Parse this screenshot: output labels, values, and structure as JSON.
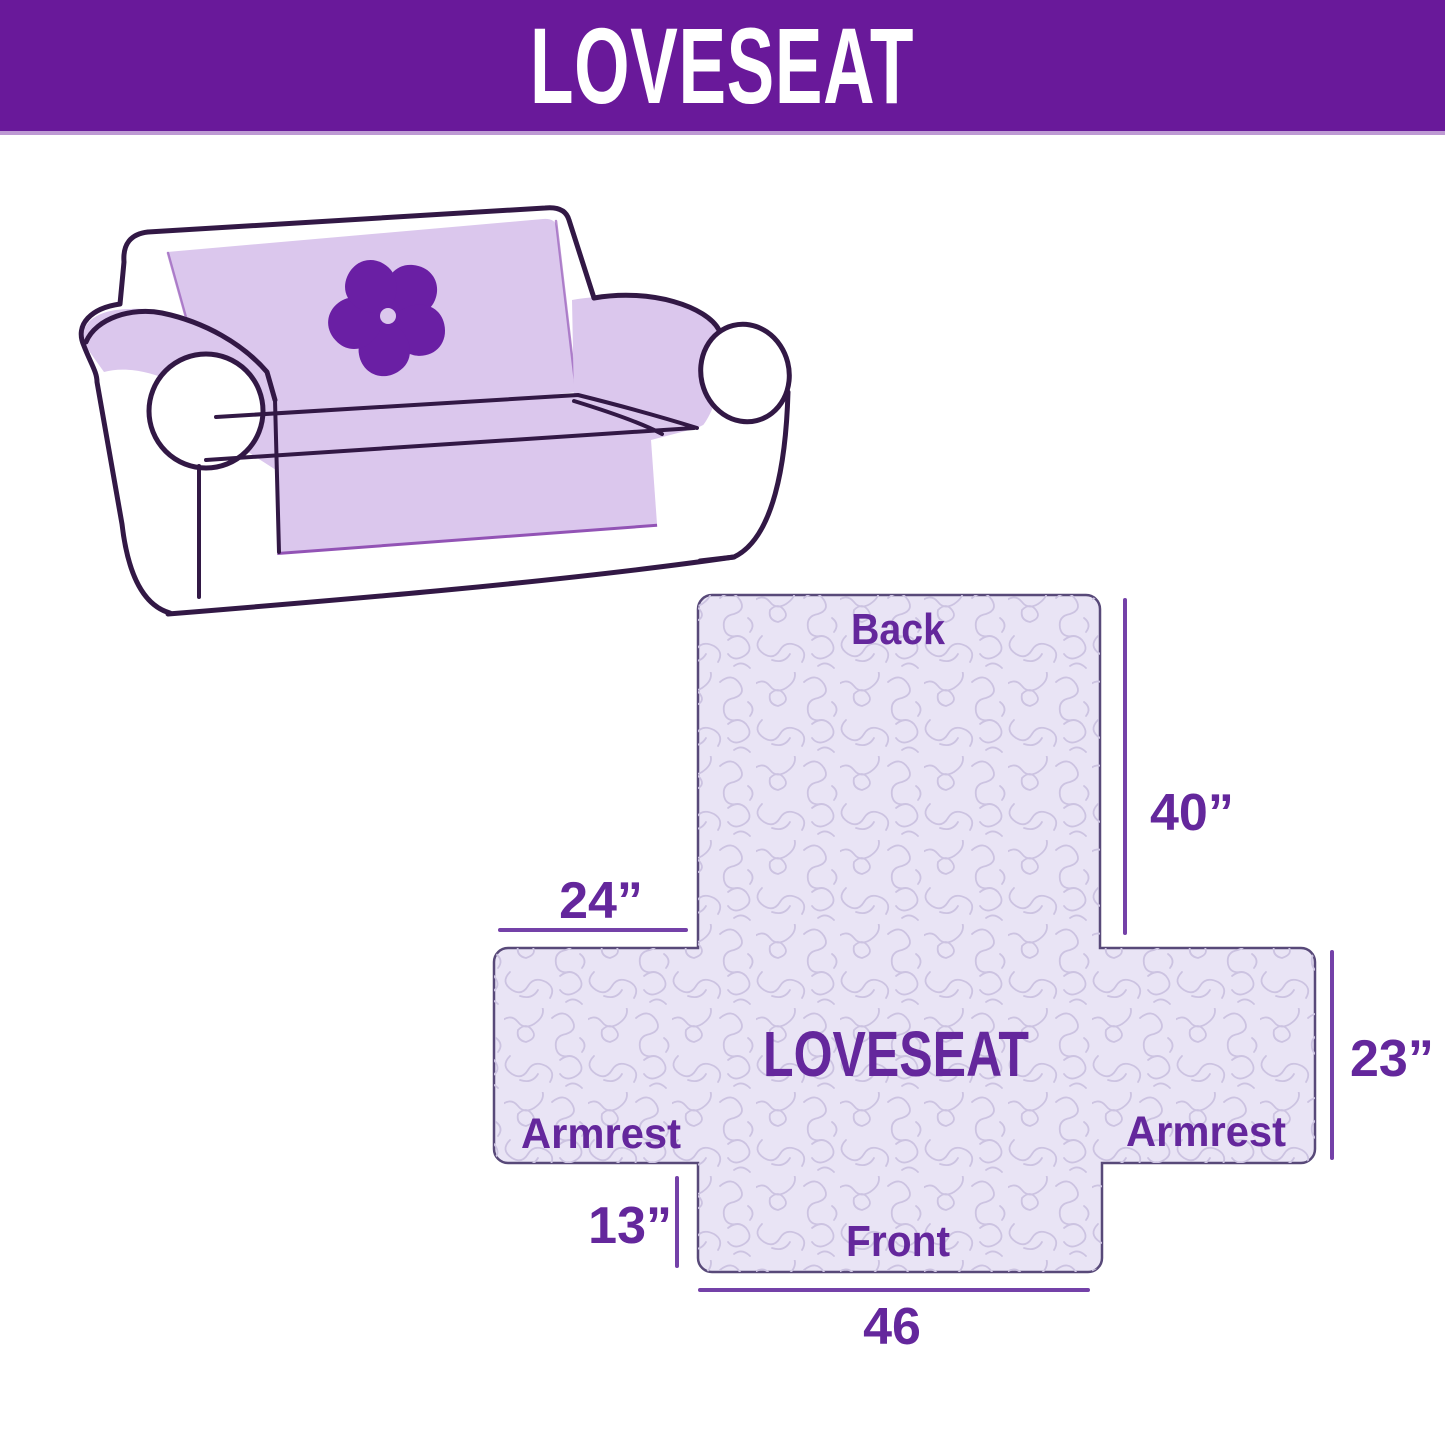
{
  "header": {
    "title": "LOVESEAT"
  },
  "illustration": {
    "description": "loveseat sofa with lavender slipcover and pinwheel logo",
    "logo": "pinwheel-flower"
  },
  "diagram": {
    "product": "LOVESEAT",
    "back_label": "Back",
    "front_label": "Front",
    "armrest_left_label": "Armrest",
    "armrest_right_label": "Armrest",
    "back_height": "40”",
    "armrest_top_width": "24”",
    "armrest_side_height": "23”",
    "front_skirt_height": "13”",
    "front_width": "46"
  },
  "colors": {
    "header_bg": "#69199A",
    "header_text": "#FFFFFF",
    "label_text": "#64279C",
    "dimension_line": "#7441A8",
    "cover_fill": "#E9E4F5",
    "cover_border": "#584979",
    "texture_line": "#CCC3E1",
    "sofa_cover": "#DBC7ED",
    "sofa_outline": "#321845",
    "logo": "#6A1FA4"
  }
}
